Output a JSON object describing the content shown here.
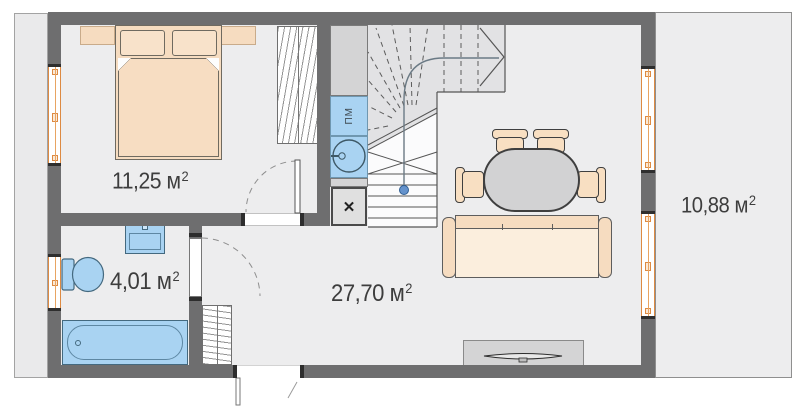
{
  "rooms": [
    {
      "name": "bedroom",
      "area": "11,25 м",
      "sup": "2"
    },
    {
      "name": "bathroom",
      "area": "4,01 м",
      "sup": "2"
    },
    {
      "name": "living-kitchen",
      "area": "27,70 м",
      "sup": "2"
    },
    {
      "name": "terrace",
      "area": "10,88 м",
      "sup": "2"
    }
  ],
  "kitchen": {
    "dishwasher_label": "ПМ",
    "appliance_symbol": "✕"
  },
  "colors": {
    "wall": "#6e6e6f",
    "floor": "#ededee",
    "furniture_beige": "#f6dcc0",
    "fixture_blue": "#a9d3f2",
    "window_orange": "#dd8a42",
    "gray_furniture": "#d4d4d5"
  }
}
